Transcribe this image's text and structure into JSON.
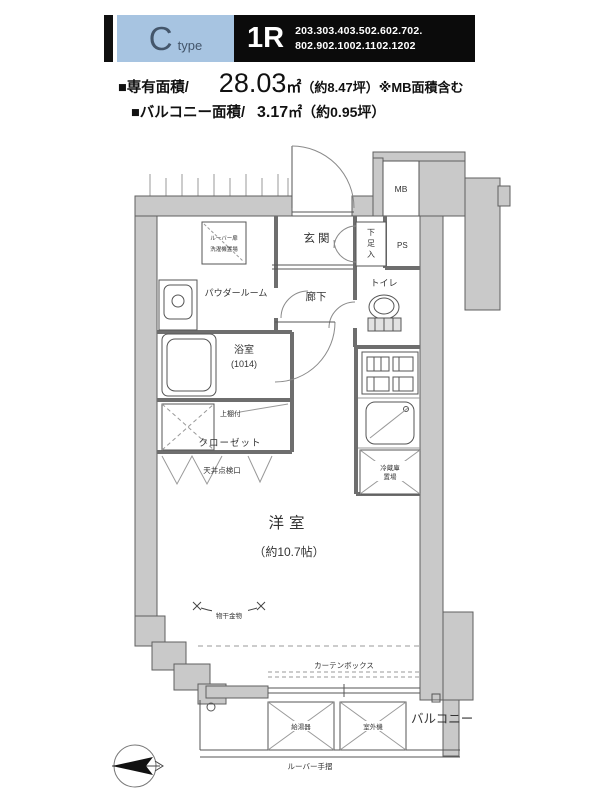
{
  "header": {
    "type_letter": "C",
    "type_word": "type",
    "layout": "1R",
    "rooms_line1": "203.303.403.502.602.702.",
    "rooms_line2": "802.902.1002.1102.1202",
    "area_label": "■専有面積/",
    "area_value": "28.03",
    "area_unit": "㎡",
    "area_note": "（約8.47坪）※MB面積含む",
    "balcony_label": "■バルコニー面積/",
    "balcony_value": "3.17",
    "balcony_note": "㎡（約0.95坪）"
  },
  "plan": {
    "genkan": "玄関",
    "shoe_chars": [
      "下",
      "足",
      "入"
    ],
    "ps": "PS",
    "mb": "MB",
    "washer_line1": "ルーバー扉",
    "washer_line2": "洗濯機置場",
    "powder_room": "パウダールーム",
    "hallway": "廊下",
    "toilet": "トイレ",
    "bathroom": "浴室",
    "bathroom_size": "(1014)",
    "upper_shelf": "上棚付",
    "closet": "クローゼット",
    "ceiling_hatch": "天井点検口",
    "fridge_line1": "冷蔵庫",
    "fridge_line2": "置場",
    "main_room": "洋室",
    "main_room_size": "（約10.7帖）",
    "laundry_hardware": "物干金物",
    "curtain_box": "カーテンボックス",
    "balcony": "バルコニー",
    "balcony_box1": "給湯器",
    "balcony_box2": "室外機",
    "handrail": "ルーバー手摺"
  }
}
